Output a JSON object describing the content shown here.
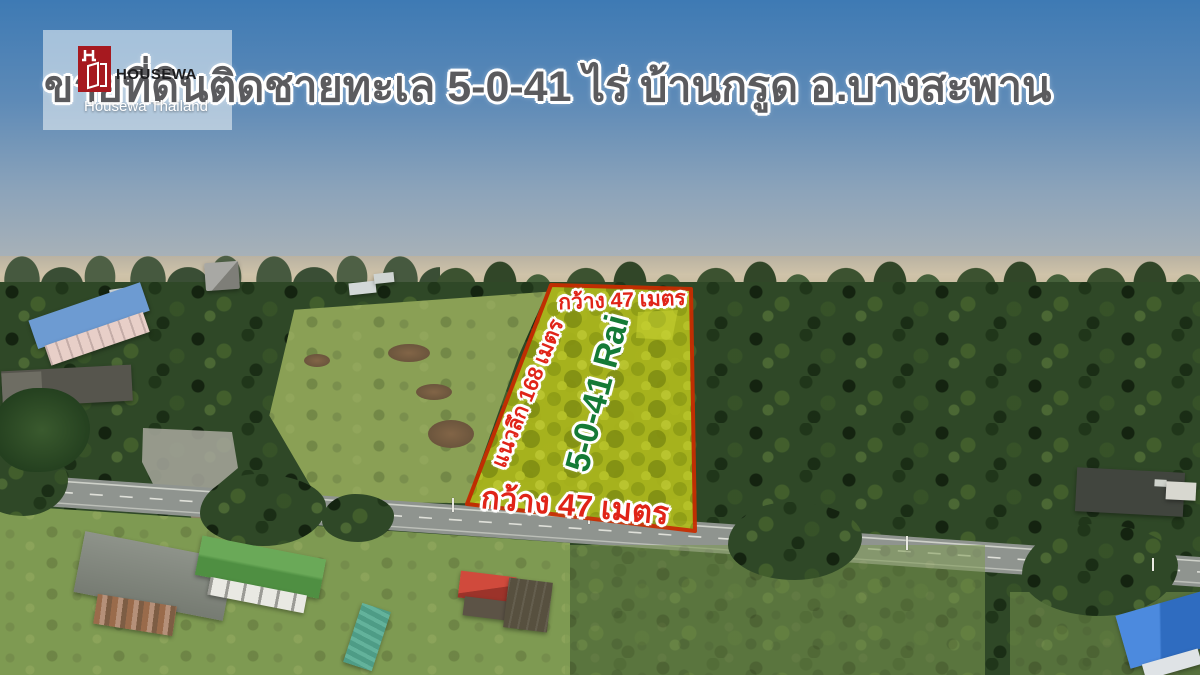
{
  "header": {
    "title": "ขายที่ดินติดชายทะเล 5-0-41 ไร่  บ้านกรูด อ.บางสะพาน"
  },
  "logo": {
    "brand": "HOUSEWA",
    "subtitle": "Housewa Thailand",
    "mark": "housewa-h-door-logo",
    "mark_color": "#a6191f"
  },
  "plot": {
    "top_width_label": "กว้าง 47 เมตร",
    "bottom_width_label": "กว้าง 47 เมตร",
    "depth_label": "แนวลึก 168 เมตร",
    "area_label": "5-0-41 Rai",
    "border_color": "#c92d00",
    "fill_color": "#aeb91d",
    "width_label_color": "#e02418",
    "area_label_color": "#157a36"
  },
  "scene": {
    "sea_top": "#3e7ab4",
    "sea_horizon": "#a9b2b8",
    "sand": "#cdbfa3",
    "forest": "#2f4827",
    "grass": "#85a055",
    "road": "#8f948f",
    "road_marking": "#e8e9e2",
    "apartment_roof": "#6d9bd2",
    "apartment_wall": "#e8cfc8",
    "green_roof": "#5fa04e",
    "red_roof": "#cc463a",
    "teal_roof": "#4e9c86",
    "blue_roof": "#4c8ade",
    "rust_roof": "#9a6b4b",
    "warehouse_roof": "#56554d"
  }
}
